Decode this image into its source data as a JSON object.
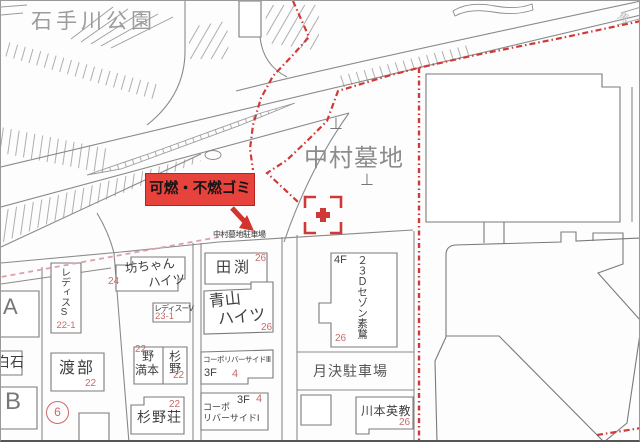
{
  "labels": {
    "park": "石手川公園",
    "cemetery": "中村墓地",
    "cemetery_parking": "中村墓地駐車場",
    "garbage": "可燃・不燃ゴミ",
    "monthly_parking": "月決駐車場",
    "grave_symbol": "⊥",
    "edge_char": "馬",
    "plot_number": "6"
  },
  "buildings": [
    {
      "name": "A"
    },
    {
      "name": "白石"
    },
    {
      "name": "B"
    },
    {
      "name": "レディスS",
      "number": "22-1"
    },
    {
      "name": "渡部",
      "number": "22"
    },
    {
      "line1": "坊ちゃん",
      "line2": "ハイツ",
      "number": "24"
    },
    {
      "name": "レディスーV",
      "number": "23-1"
    },
    {
      "line1": "野",
      "line2": "満本",
      "number": "22"
    },
    {
      "name": "杉野",
      "number": "22"
    },
    {
      "name": "杉野荘",
      "number": "22"
    },
    {
      "name": "田渕",
      "number": "26"
    },
    {
      "line1": "青山",
      "line2": "ハイツ",
      "number": "26"
    },
    {
      "name": "コーポリバーサイドⅢ",
      "floor": "3F",
      "number": "4"
    },
    {
      "line1": "コーポ",
      "line2": "リバーサイドⅠ",
      "floor": "3F",
      "number": "4"
    },
    {
      "name": "２３Ｄセゾン素鵞",
      "floor": "4F",
      "number": "26"
    },
    {
      "name": "川本英教",
      "number": "26"
    }
  ],
  "colors": {
    "accent_red": "#cf3a38",
    "garbage_label_fill": "#e8423c",
    "number_red": "#c96a6a",
    "line_gray": "#8a8a8a"
  }
}
